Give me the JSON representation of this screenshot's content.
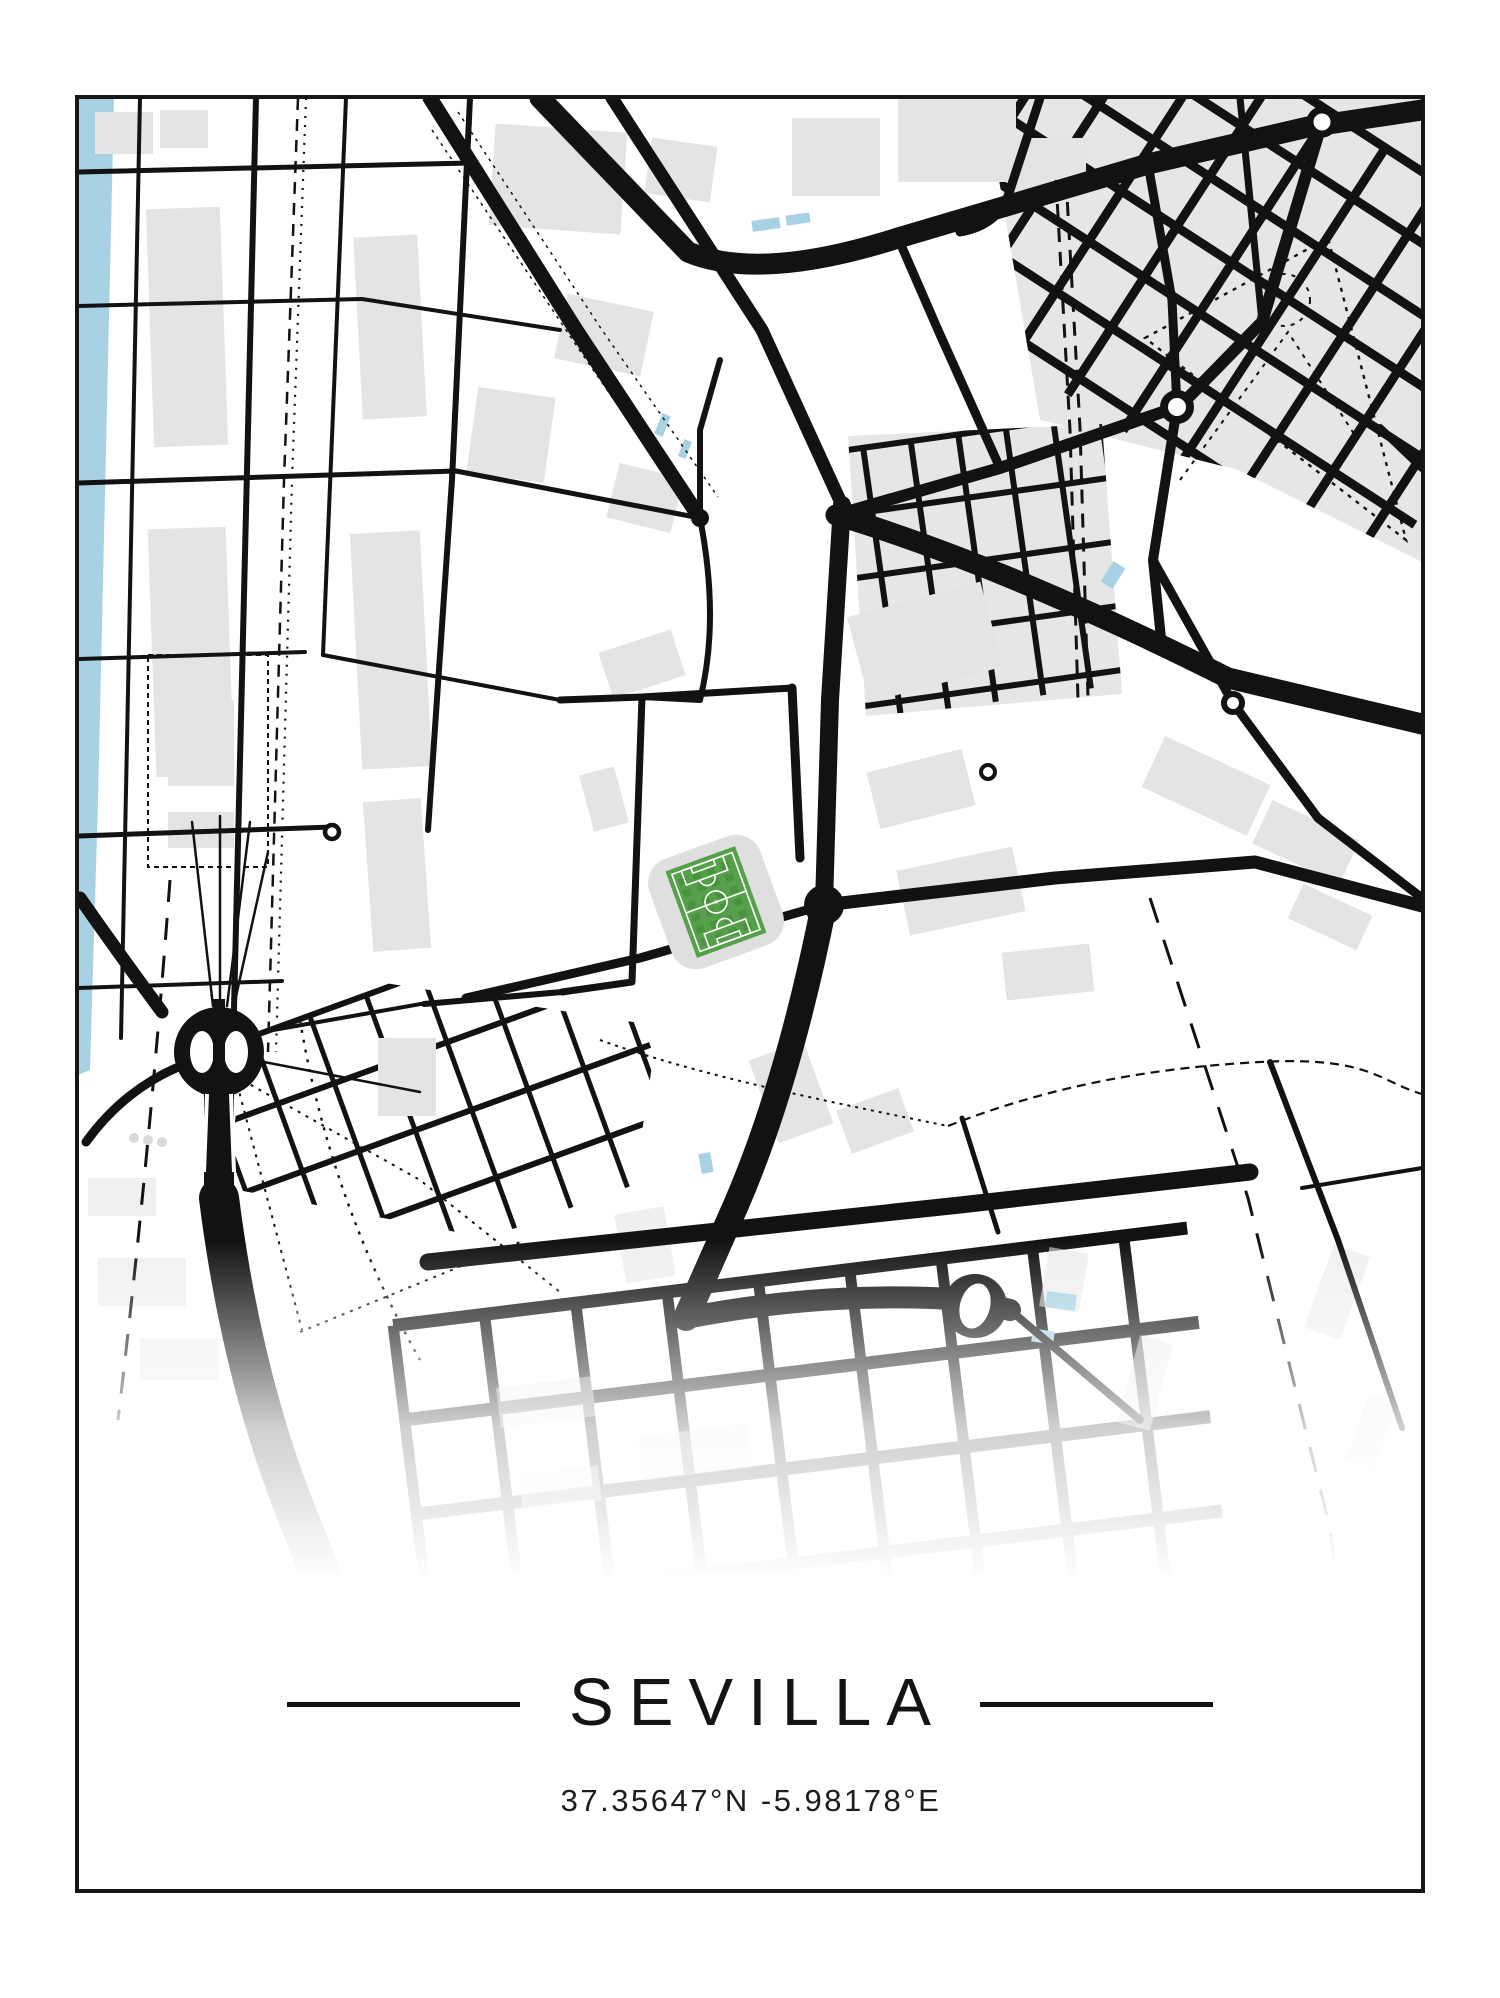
{
  "poster": {
    "title": "SEVILLA",
    "coordinates": "37.35647°N -5.98178°E"
  },
  "colors": {
    "background": "#ffffff",
    "road": "#121212",
    "building": "#e4e4e4",
    "underlay": "#e6e6e6",
    "water": "#a8d1e3",
    "pitch": "#57a04b",
    "pitch_dark": "#4a9140",
    "pitch_line": "#ffffff",
    "frame": "#161616",
    "dot_gray": "#d9d9d9"
  },
  "map": {
    "water": [
      "78,98 114,98 106,450 98,800 90,1070 78,1075"
    ],
    "ponds": [
      [
        752,
        219,
        28,
        11,
        -8
      ],
      [
        786,
        214,
        24,
        10,
        -8
      ],
      [
        658,
        414,
        9,
        22,
        22
      ],
      [
        681,
        440,
        8,
        18,
        22
      ],
      [
        1106,
        563,
        14,
        24,
        32
      ],
      [
        700,
        1153,
        12,
        20,
        -10
      ],
      [
        1046,
        1293,
        30,
        16,
        8
      ],
      [
        1032,
        1330,
        22,
        13,
        8
      ]
    ],
    "grids": [
      {
        "clip": "985,98 1422,98 1422,562 1238,470 1040,420",
        "cx": 1240,
        "cy": 280,
        "rot": 33,
        "x0": -280,
        "x1": 280,
        "stepx": 66,
        "y0": -190,
        "y1": 190,
        "stepy": 60,
        "wv": 9,
        "wh": 9,
        "underlay": true
      },
      {
        "clip": "848,436 1102,424 1122,694 866,716",
        "cx": 978,
        "cy": 568,
        "rot": -8,
        "x0": -145,
        "x1": 145,
        "stepx": 48,
        "y0": -135,
        "y1": 135,
        "stepy": 64,
        "wv": 6,
        "wh": 6,
        "underlay": true
      },
      {
        "clip": "252,962 658,1026 622,1264 228,1188",
        "cx": 445,
        "cy": 1110,
        "rot": -20,
        "x0": -215,
        "x1": 215,
        "stepx": 60,
        "y0": -135,
        "y1": 135,
        "stepy": 72,
        "wv": 5,
        "wh": 6,
        "underlay": false
      },
      {
        "clip": "360,1232 1298,1130 1310,1893 330,1893",
        "cx": 820,
        "cy": 1520,
        "rot": -7,
        "x0": -400,
        "x1": 400,
        "stepx": 92,
        "y0": -245,
        "y1": 330,
        "stepy": 95,
        "wv": 11,
        "wh": 13,
        "underlay": false
      }
    ],
    "buildings": [
      [
        95,
        112,
        58,
        42,
        0,
        1
      ],
      [
        160,
        110,
        48,
        38,
        0,
        1
      ],
      [
        150,
        208,
        74,
        238,
        -2,
        1
      ],
      [
        152,
        528,
        78,
        248,
        -2,
        1
      ],
      [
        358,
        236,
        64,
        182,
        -3,
        1
      ],
      [
        356,
        532,
        70,
        236,
        -3,
        1
      ],
      [
        368,
        800,
        58,
        150,
        -4,
        1
      ],
      [
        168,
        700,
        66,
        86,
        0,
        1
      ],
      [
        168,
        812,
        66,
        36,
        0,
        1
      ],
      [
        492,
        128,
        132,
        102,
        4,
        1
      ],
      [
        648,
        142,
        66,
        56,
        8,
        1
      ],
      [
        560,
        302,
        88,
        66,
        12,
        1
      ],
      [
        472,
        392,
        78,
        86,
        8,
        1
      ],
      [
        612,
        470,
        66,
        56,
        14,
        1
      ],
      [
        792,
        118,
        88,
        78,
        0,
        1
      ],
      [
        898,
        94,
        118,
        88,
        0,
        1
      ],
      [
        1008,
        138,
        78,
        58,
        0,
        1
      ],
      [
        856,
        598,
        138,
        88,
        -15,
        1
      ],
      [
        872,
        760,
        98,
        58,
        -14,
        1
      ],
      [
        902,
        858,
        118,
        66,
        -12,
        1
      ],
      [
        1004,
        948,
        88,
        48,
        -6,
        1
      ],
      [
        762,
        1048,
        58,
        88,
        -20,
        1
      ],
      [
        842,
        1098,
        66,
        46,
        -20,
        1
      ],
      [
        604,
        640,
        76,
        48,
        -18,
        1
      ],
      [
        586,
        770,
        36,
        58,
        -15,
        1
      ],
      [
        1148,
        758,
        116,
        56,
        25,
        1
      ],
      [
        1258,
        818,
        96,
        48,
        25,
        1
      ],
      [
        1292,
        898,
        76,
        38,
        25,
        1
      ],
      [
        1318,
        1248,
        38,
        88,
        20,
        0.55
      ],
      [
        1356,
        1398,
        30,
        68,
        20,
        0.55
      ],
      [
        1128,
        1338,
        34,
        90,
        15,
        0.55
      ],
      [
        88,
        1178,
        68,
        38,
        0,
        0.55
      ],
      [
        98,
        1258,
        88,
        48,
        0,
        0.55
      ],
      [
        140,
        1338,
        78,
        42,
        0,
        0.55
      ],
      [
        378,
        1038,
        58,
        78,
        0,
        1
      ],
      [
        498,
        1382,
        96,
        40,
        -7,
        0.5
      ],
      [
        640,
        1430,
        110,
        44,
        -7,
        0.5
      ],
      [
        520,
        1470,
        80,
        36,
        -7,
        0.5
      ],
      [
        1044,
        1250,
        40,
        60,
        10,
        0.6
      ],
      [
        620,
        1210,
        50,
        70,
        -10,
        0.6
      ]
    ],
    "dashed": [
      {
        "d": "M298,98 L284,480 L268,1052",
        "w": 2.5,
        "da": "12 9"
      },
      {
        "d": "M306,98 L292,480 L276,1052",
        "w": 2.2,
        "da": "2 7"
      },
      {
        "d": "M1056,180 L1070,430 L1078,700",
        "w": 3,
        "da": "14 10"
      },
      {
        "d": "M1066,178 L1080,428 L1088,698",
        "w": 3,
        "da": "14 10"
      },
      {
        "d": "M1150,898 L1248,1198 L1328,1520 L1388,1893",
        "w": 3,
        "da": "26 18"
      },
      {
        "d": "M1145,338 L1328,238 L1406,540 Z",
        "w": 2.4,
        "da": "4 6"
      },
      {
        "d": "M1180,480 L1288,332 L1358,440",
        "w": 2,
        "da": "4 6"
      },
      {
        "d": "M948,1126 C1050,1086 1150,1068 1260,1062 S1380,1082 1422,1094",
        "w": 2.2,
        "da": "9 6"
      },
      {
        "d": "M600,1040 C700,1076 830,1102 948,1126",
        "w": 2,
        "da": "3 5"
      },
      {
        "d": "M235,1076 L420,1180 L560,1292",
        "w": 2,
        "da": "3 6"
      },
      {
        "d": "M300,1332 L520,1242",
        "w": 2,
        "da": "3 6"
      },
      {
        "d": "M235,1076 L302,1330",
        "w": 2,
        "da": "3 6"
      },
      {
        "d": "M432,130 L578,348 L694,515",
        "w": 1.5,
        "da": "3 5"
      },
      {
        "d": "M458,112 L602,330 L718,497",
        "w": 1.5,
        "da": "3 5"
      },
      {
        "d": "M170,880 Q150,1150 118,1420",
        "w": 3,
        "da": "22 16"
      },
      {
        "d": "M300,1020 Q330,1200 420,1360",
        "w": 2.4,
        "da": "3 7"
      },
      {
        "d": "M148,655 l120,0 l0,212 l-120,0 Z",
        "w": 2,
        "da": "5 4"
      }
    ],
    "dotted_circles": [
      [
        1284,
        300,
        26,
        2,
        "4 6"
      ]
    ],
    "roads": [
      {
        "d": "M540,98 L688,252 Q760,282 898,238 L1148,164 L1308,127 L1422,110",
        "w": 21
      },
      {
        "d": "M430,98 L576,330 L700,518",
        "w": 15
      },
      {
        "d": "M612,98 L762,330 L842,505",
        "w": 13
      },
      {
        "d": "M842,505 L830,700 L824,905",
        "w": 18
      },
      {
        "d": "M836,515 Q1005,566 1228,678 L1422,724",
        "w": 21
      },
      {
        "d": "M824,905 L1055,878 L1255,862 L1422,906",
        "w": 13
      },
      {
        "d": "M824,905 Q788,1085 736,1205 L686,1318",
        "w": 26
      },
      {
        "d": "M1322,122 L1262,322 L1182,404",
        "w": 12
      },
      {
        "d": "M1240,98 L1262,322",
        "w": 7
      },
      {
        "d": "M1177,407 L1153,560 L1162,648",
        "w": 10
      },
      {
        "d": "M1153,560 L1233,703 L1318,818 L1422,898",
        "w": 9
      },
      {
        "d": "M1177,407 L1000,468 L836,515",
        "w": 12
      },
      {
        "d": "M898,238 L938,330 L1000,468",
        "w": 9
      },
      {
        "d": "M1148,164 L1172,300 L1177,407",
        "w": 9
      },
      {
        "d": "M1040,98 L1010,190 Q1000,225 960,232",
        "w": 9
      },
      {
        "d": "M78,172 L470,163",
        "w": 5
      },
      {
        "d": "M78,306 L362,299",
        "w": 4
      },
      {
        "d": "M78,483 L456,471",
        "w": 5
      },
      {
        "d": "M78,659 L305,652",
        "w": 4
      },
      {
        "d": "M78,836 L332,827",
        "w": 5
      },
      {
        "d": "M78,988 L282,981",
        "w": 4
      },
      {
        "d": "M140,98 L121,1038",
        "w": 4
      },
      {
        "d": "M256,98 L233,1050",
        "w": 6
      },
      {
        "d": "M346,98 L323,655",
        "w": 4
      },
      {
        "d": "M470,98 L452,480 L428,830",
        "w": 6
      },
      {
        "d": "M362,299 L560,330",
        "w": 4
      },
      {
        "d": "M456,471 L700,518",
        "w": 5
      },
      {
        "d": "M323,655 L560,700",
        "w": 4
      },
      {
        "d": "M560,700 L642,697 L792,688",
        "w": 7
      },
      {
        "d": "M642,697 L632,982 L562,992",
        "w": 7
      },
      {
        "d": "M792,688 L800,858",
        "w": 9
      },
      {
        "d": "M824,905 L640,958 L466,998",
        "w": 9
      },
      {
        "d": "M562,992 L424,1004",
        "w": 6
      },
      {
        "d": "M700,518 Q720,620 700,700 L642,697",
        "w": 6
      },
      {
        "d": "M700,518 L700,430 L720,360",
        "w": 6
      },
      {
        "d": "M1380,428 L1422,468",
        "w": 8
      },
      {
        "d": "M1270,1062 L1338,1240 L1402,1428",
        "w": 6
      },
      {
        "d": "M1302,1188 L1422,1168",
        "w": 4
      },
      {
        "d": "M962,1118 L998,1232",
        "w": 5
      },
      {
        "d": "M192,822 L213,1006",
        "w": 2.5
      },
      {
        "d": "M220,816 L220,1006",
        "w": 2.5
      },
      {
        "d": "M250,822 L227,1006",
        "w": 2.5
      },
      {
        "d": "M268,852 L233,1010",
        "w": 2.5
      },
      {
        "d": "M80,898 Q122,958 162,1012",
        "w": 13
      },
      {
        "d": "M176,1068 Q122,1092 86,1142",
        "w": 9
      },
      {
        "d": "M262,1032 L432,1002",
        "w": 4
      },
      {
        "d": "M264,1062 L420,1092",
        "w": 2.5
      },
      {
        "d": "M219,1086 L219,1198",
        "w": 30,
        "cap": "butt"
      },
      {
        "d": "M219,1198 Q242,1380 300,1522 L352,1655",
        "w": 40
      },
      {
        "d": "M428,1262 L960,1205 L1250,1172",
        "w": 17
      },
      {
        "d": "M686,1318 Q830,1290 968,1300 L1010,1310",
        "w": 22
      },
      {
        "d": "M1010,1310 L1140,1420",
        "w": 8
      }
    ],
    "junctions": [
      [
        824,
        905,
        20
      ],
      [
        700,
        518,
        9
      ],
      [
        836,
        515,
        9
      ]
    ],
    "big_ring": {
      "cx": 219,
      "cy": 1052,
      "r": 45,
      "holeDx": 17,
      "holeRx": 12,
      "holeRy": 21,
      "roadW": 12
    },
    "oval_ring": {
      "cx": 975,
      "cy": 1306,
      "r": 32,
      "rx": 15,
      "ry": 23,
      "rot": 15
    },
    "roundabouts": [
      [
        1322,
        122,
        12,
        7
      ],
      [
        1177,
        407,
        13,
        8
      ],
      [
        1233,
        703,
        9,
        6
      ],
      [
        988,
        772,
        7,
        4
      ],
      [
        332,
        832,
        7,
        4.5
      ]
    ],
    "gray_dots": [
      [
        134,
        1138,
        5
      ],
      [
        148,
        1140,
        5
      ],
      [
        162,
        1142,
        5
      ]
    ],
    "stadium": {
      "cx": 716,
      "cy": 902,
      "rot": -20,
      "bw": 118,
      "bh": 116,
      "brx": 26,
      "pw": 74,
      "ph": 92
    },
    "fade": {
      "y0": 1240,
      "y1": 1580
    }
  }
}
